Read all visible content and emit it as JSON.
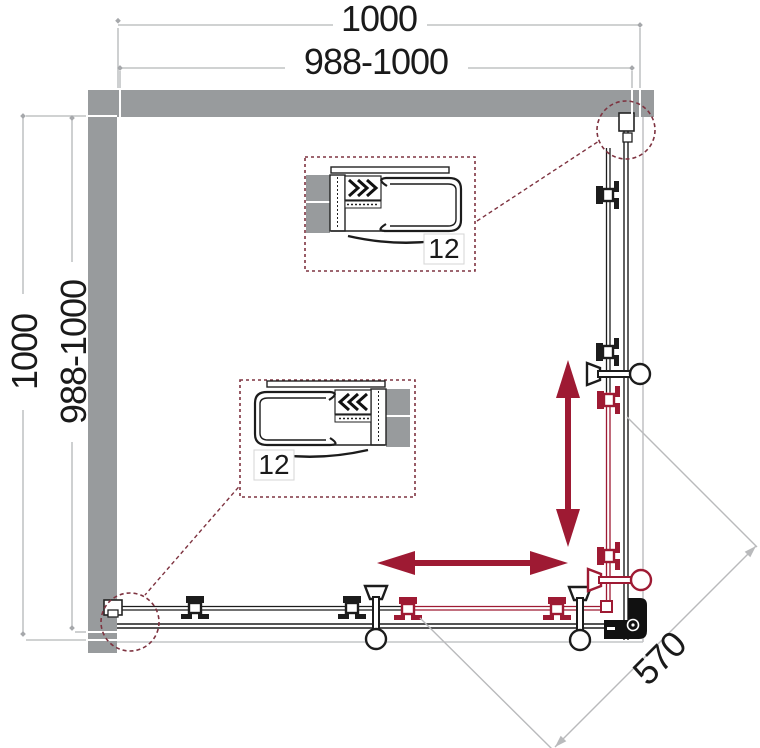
{
  "diagram": {
    "kind": "shower-enclosure-plan",
    "dimensions": {
      "top_total": "1000",
      "top_adjust": "988-1000",
      "left_total": "1000",
      "left_adjust": "988-1000",
      "diagonal_entry": "570"
    },
    "details": {
      "upper_label": "12",
      "lower_label": "12"
    },
    "colors": {
      "wall": "#989b9d",
      "dim": "#b4b6b8",
      "ink": "#1c1c1c",
      "red": "#9e1a33",
      "maroon": "#7e3340",
      "tray": "#c4c5c7",
      "paper": "#ffffff",
      "text": "#1a1a1a"
    }
  }
}
